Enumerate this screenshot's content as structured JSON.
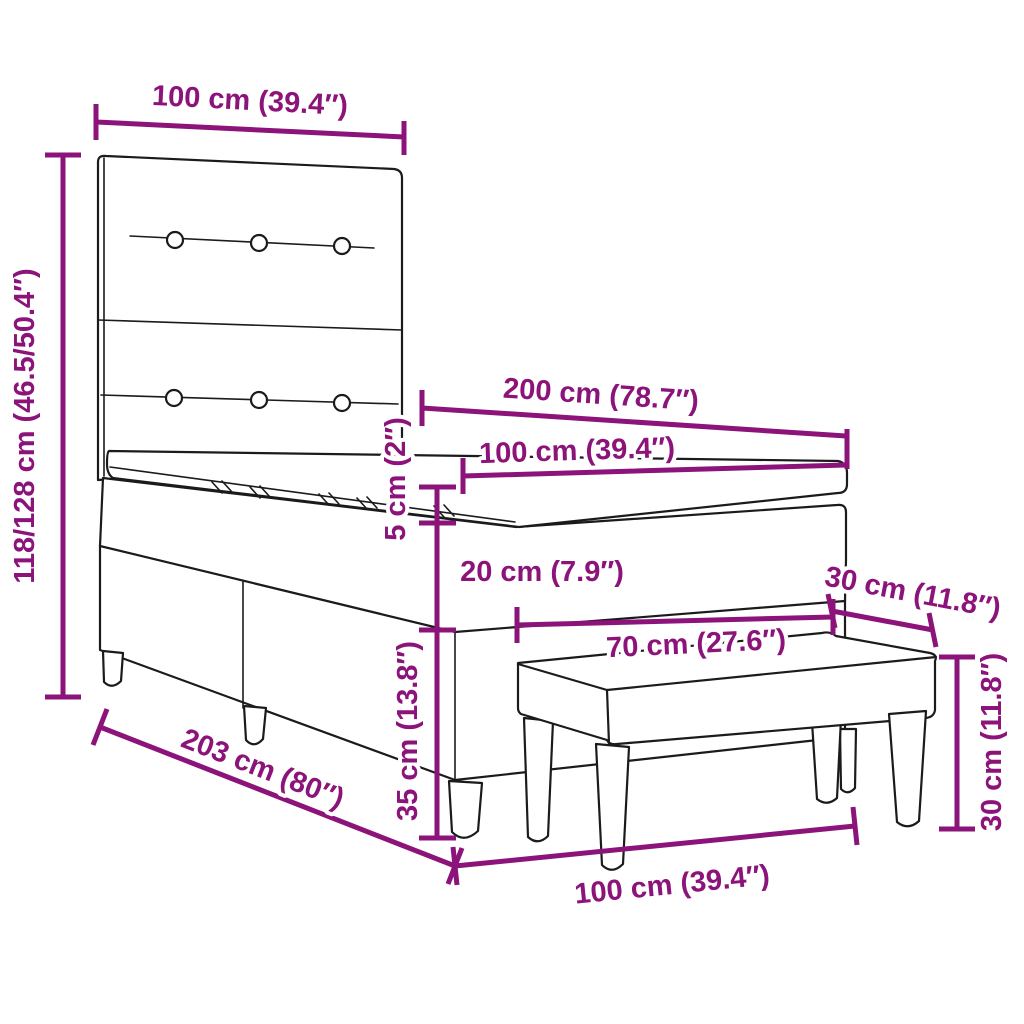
{
  "figure": {
    "type": "product-dimension-diagram",
    "subject": "box spring bed with headboard, mattress, topper and bench",
    "background_color": "#ffffff",
    "line_art_color": "#1b1b1b",
    "dimension_color": "#8C1379"
  },
  "dimensions": {
    "headboard_width": "100 cm (39.4″)",
    "headboard_height_range": "118/128 cm (46.5/50.4″)",
    "bed_length": "200 cm (78.7″)",
    "mattress_width": "100 cm (39.4″)",
    "topper_thickness": "5 cm (2″)",
    "mattress_thickness": "20 cm (7.9″)",
    "base_height": "35 cm (13.8″)",
    "bench_length": "70 cm (27.6″)",
    "bench_depth": "30 cm (11.8″)",
    "bench_height": "30 cm (11.8″)",
    "total_bed_length": "203 cm (80″)",
    "bed_width": "100 cm (39.4″)"
  }
}
